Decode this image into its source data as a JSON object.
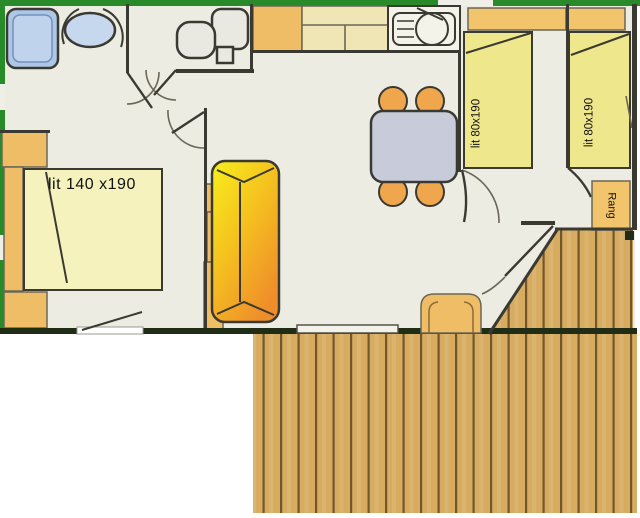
{
  "plan": {
    "type": "mobile-home floor plan with wooden deck",
    "labels": {
      "bed_double": "lit 140 x190",
      "bed_single_left": "lit 80x190",
      "bed_single_right": "lit 80x190",
      "storage": "Rang"
    }
  },
  "colors": {
    "green": "#288A28",
    "wall": "#3B3A32",
    "wall_dark": "#1F2D16",
    "floor": "#ECECE3",
    "bed_yellow": "#EFE78C",
    "bed_pale": "#F5F2BE",
    "tan": "#EFBD66",
    "tan2": "#F2C46B",
    "beige": "#EFE5B5",
    "sofa_yellow": "#F6EF1C",
    "sofa_orange": "#EF8D2B",
    "table_gray": "#C7CBDA",
    "chair_orange": "#F0A64C",
    "shower_blue": "#AEC7E7",
    "sink_blue": "#C6D8EE",
    "fixture": "#E9E9E1",
    "wood": "#D7AC60",
    "wood_gap": "#71562C"
  }
}
